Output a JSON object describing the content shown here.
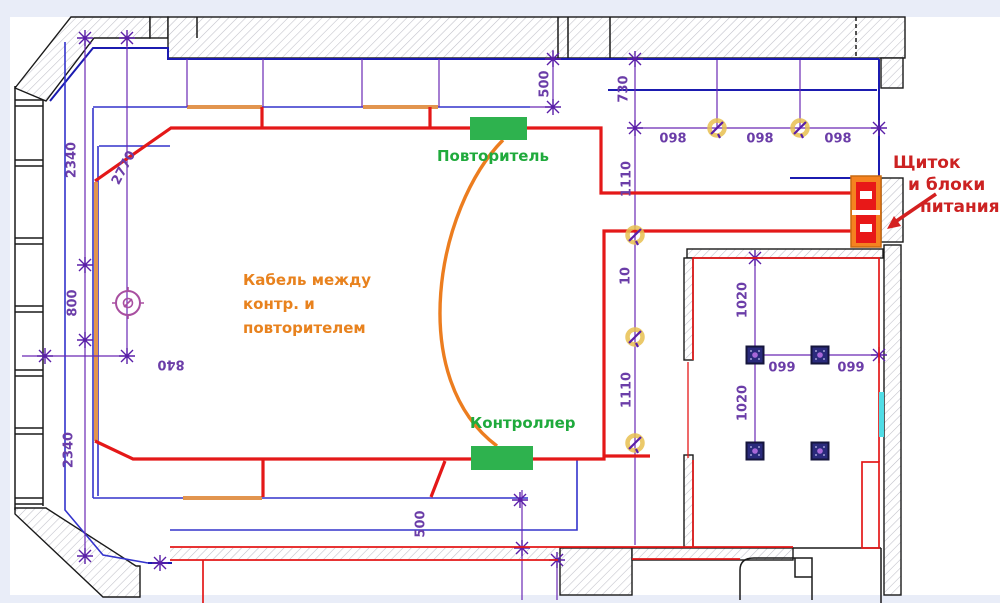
{
  "equipment": {
    "repeater_label": "Повторитель",
    "controller_label": "Контроллер",
    "cable_note": [
      "Кабель между",
      "контр. и",
      "повторителем"
    ],
    "power_panel_note": [
      "Щиток",
      "и блоки",
      "питания"
    ]
  },
  "dimensions": {
    "left_wall_top": "2340",
    "left_wall_diagonal": "2770",
    "left_wall_middle": "800",
    "left_wall_bottom": "2340",
    "left_horizontal": "840",
    "top_right_offset": "500",
    "top_corridor": "730",
    "corridor_span_1": "1110",
    "corridor_span_2": "10",
    "corridor_span_3": "1110",
    "bottom_offset": "500",
    "ceiling_lights_1": "098",
    "ceiling_lights_2": "098",
    "ceiling_lights_3": "098",
    "room2_vertical_1": "1020",
    "room2_vertical_2": "1020",
    "room2_horizontal_1": "099",
    "room2_horizontal_2": "099"
  },
  "colors": {
    "led_line_red": "#e41818",
    "cable_orange": "#ec7d1f",
    "led_segment_orange": "#e2954f",
    "cove_line_blue": "#3333cc",
    "wall_edge_blue": "#1b1bb0",
    "dimension_purple": "#6a28b4",
    "equipment_green": "#2eb24e",
    "panel_orange": "#f58220",
    "label_green": "#1faa3c",
    "label_orange": "#e8821e",
    "label_red": "#cc2222",
    "door_cyan": "#50dde6"
  }
}
